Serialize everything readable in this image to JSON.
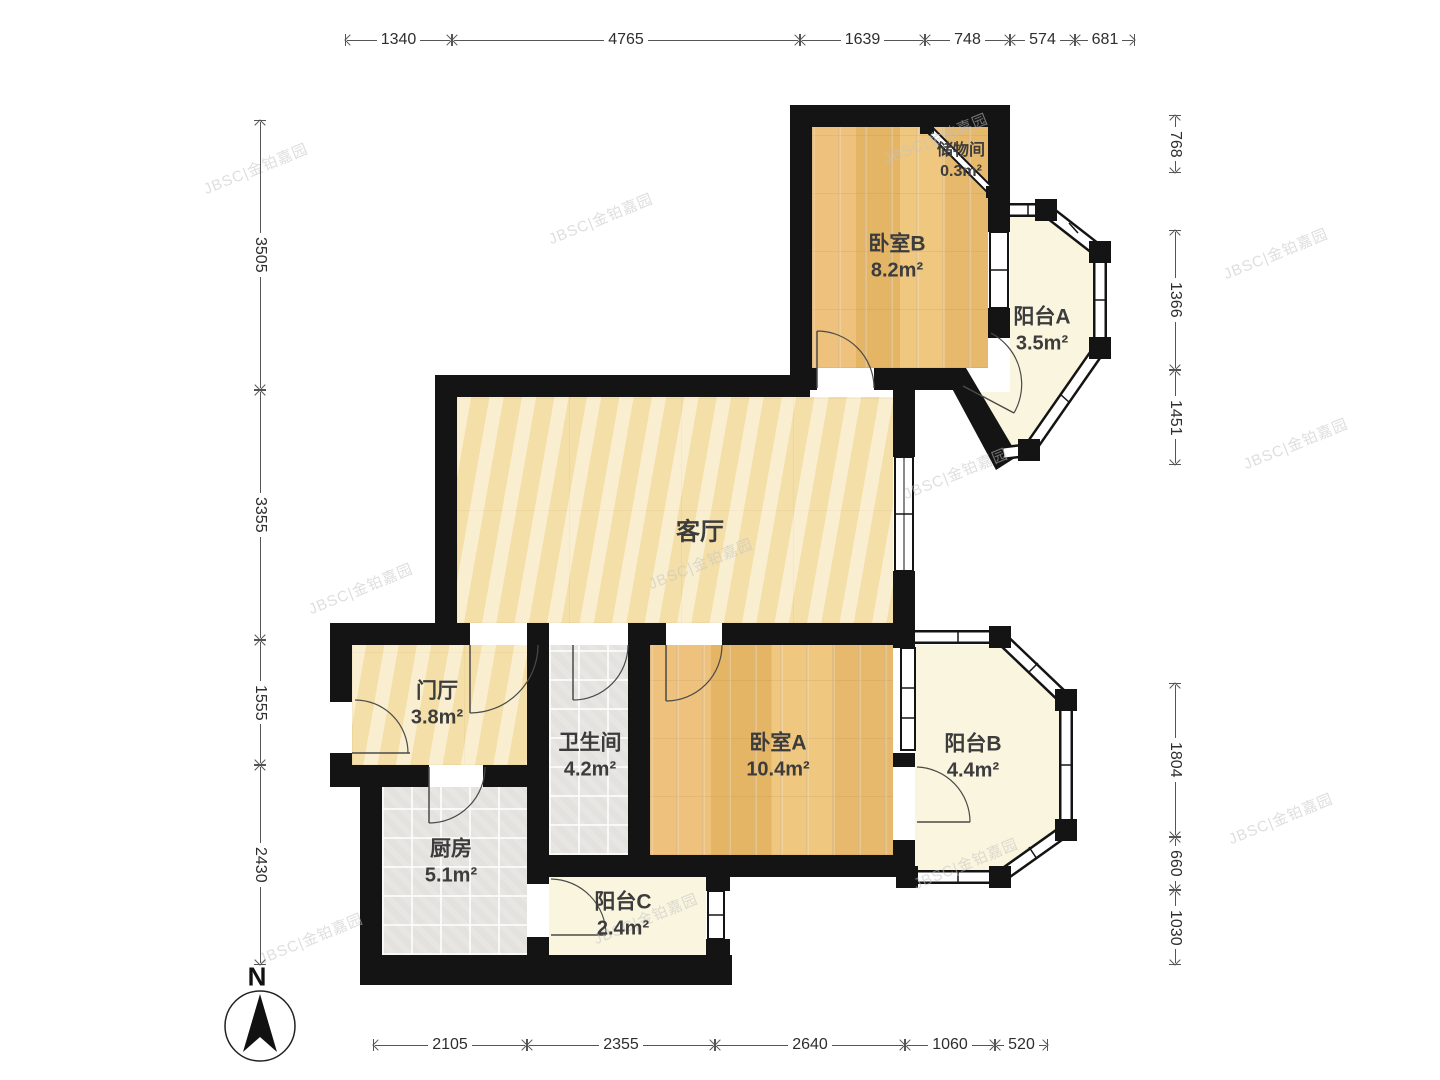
{
  "rooms": [
    {
      "id": "living",
      "name": "客厅",
      "area": ""
    },
    {
      "id": "bedroomB",
      "name": "卧室B",
      "area": "8.2m²"
    },
    {
      "id": "storage",
      "name": "储物间",
      "area": "0.3m²"
    },
    {
      "id": "balconyA",
      "name": "阳台A",
      "area": "3.5m²"
    },
    {
      "id": "hall",
      "name": "门厅",
      "area": "3.8m²"
    },
    {
      "id": "bathroom",
      "name": "卫生间",
      "area": "4.2m²"
    },
    {
      "id": "kitchen",
      "name": "厨房",
      "area": "5.1m²"
    },
    {
      "id": "balconyC",
      "name": "阳台C",
      "area": "2.4m²"
    },
    {
      "id": "bedroomA",
      "name": "卧室A",
      "area": "10.4m²"
    },
    {
      "id": "balconyB",
      "name": "阳台B",
      "area": "4.4m²"
    }
  ],
  "dimensions": {
    "top": [
      "1340",
      "4765",
      "1639",
      "748",
      "574",
      "681"
    ],
    "left": [
      "3505",
      "3355",
      "1555",
      "2430"
    ],
    "right": [
      "768",
      "1366",
      "1451",
      "1804",
      "660",
      "1030"
    ],
    "bottom": [
      "2105",
      "2355",
      "2640",
      "1060",
      "520"
    ]
  },
  "compass": {
    "label": "N"
  },
  "watermark": {
    "text": "JBSC|金铂嘉园"
  },
  "palette": {
    "wall": "#141414",
    "wood_floor": "#e9bd72",
    "marble_floor": "#f6e5b4",
    "tile_floor": "#e8e6e2",
    "balcony_floor": "#faf5df",
    "dimension_text": "#2e2e2e",
    "label_text": "#3c3c3c",
    "watermark_text": "#c3c3c3"
  }
}
